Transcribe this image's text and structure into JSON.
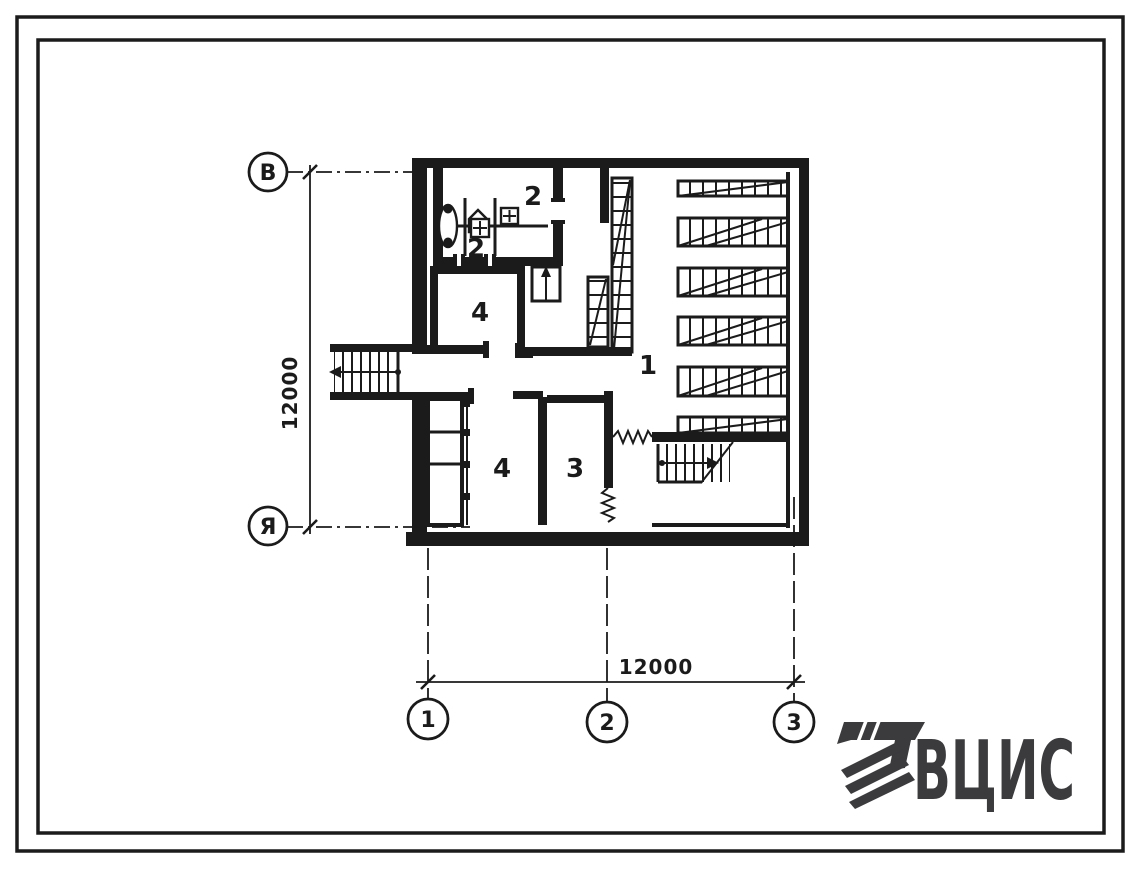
{
  "colors": {
    "ink": "#1b1b1b",
    "logo": "#3b3b3e",
    "paper": "#ffffff"
  },
  "axis_markers": {
    "row_top": "В",
    "row_bottom": "Я",
    "col_left": "1",
    "col_middle": "2",
    "col_right": "3"
  },
  "dimensions": {
    "vertical": "12000",
    "horizontal": "12000"
  },
  "room_labels": {
    "storage_hall": "1",
    "sanitary_upper": "2",
    "sanitary_lower": "2",
    "room_3": "3",
    "room_4_upper": "4",
    "room_4_lower": "4"
  },
  "logo": {
    "text": "ВЦИС"
  }
}
